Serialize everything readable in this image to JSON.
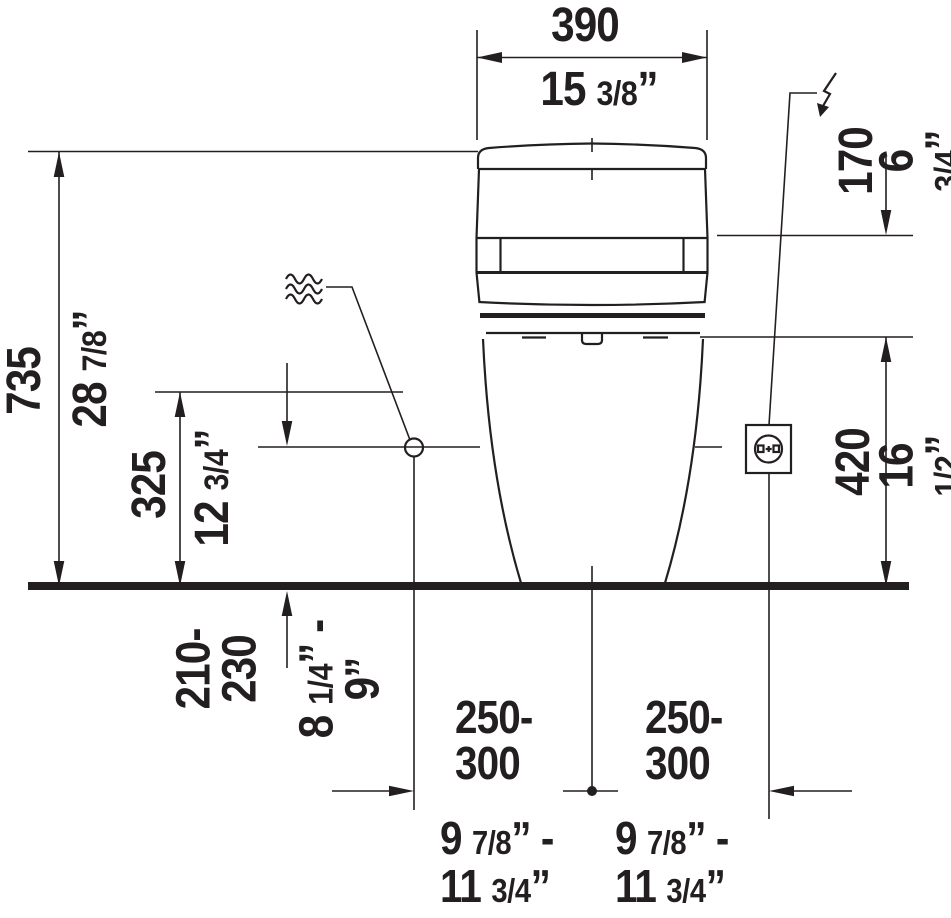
{
  "colors": {
    "ink": "#231f20",
    "background": "#ffffff"
  },
  "dimensions": {
    "top_width": {
      "mm": "390",
      "inch": "15 3/8”"
    },
    "total_height": {
      "mm": "735",
      "inch": "28 7/8”"
    },
    "mid_height": {
      "mm": "325",
      "inch": "12 3/4”"
    },
    "tank_top_offset": {
      "mm": "170",
      "inch": "6 3/4”"
    },
    "seat_height": {
      "mm": "420",
      "inch": "16 1/2”"
    },
    "supply_height": {
      "mm": "210-\n230",
      "inch": "8 1/4” -\n9”"
    },
    "left_offset": {
      "mm": "250-\n300",
      "inch": "9 7/8” -\n11 3/4”"
    },
    "right_offset": {
      "mm": "250-\n300",
      "inch": "9 7/8” -\n11 3/4”"
    }
  },
  "symbols": {
    "water_supply_icon": "triple-wave",
    "electric_supply_icon": "lightning-bolt",
    "power_outlet_icon": "socket-square"
  }
}
